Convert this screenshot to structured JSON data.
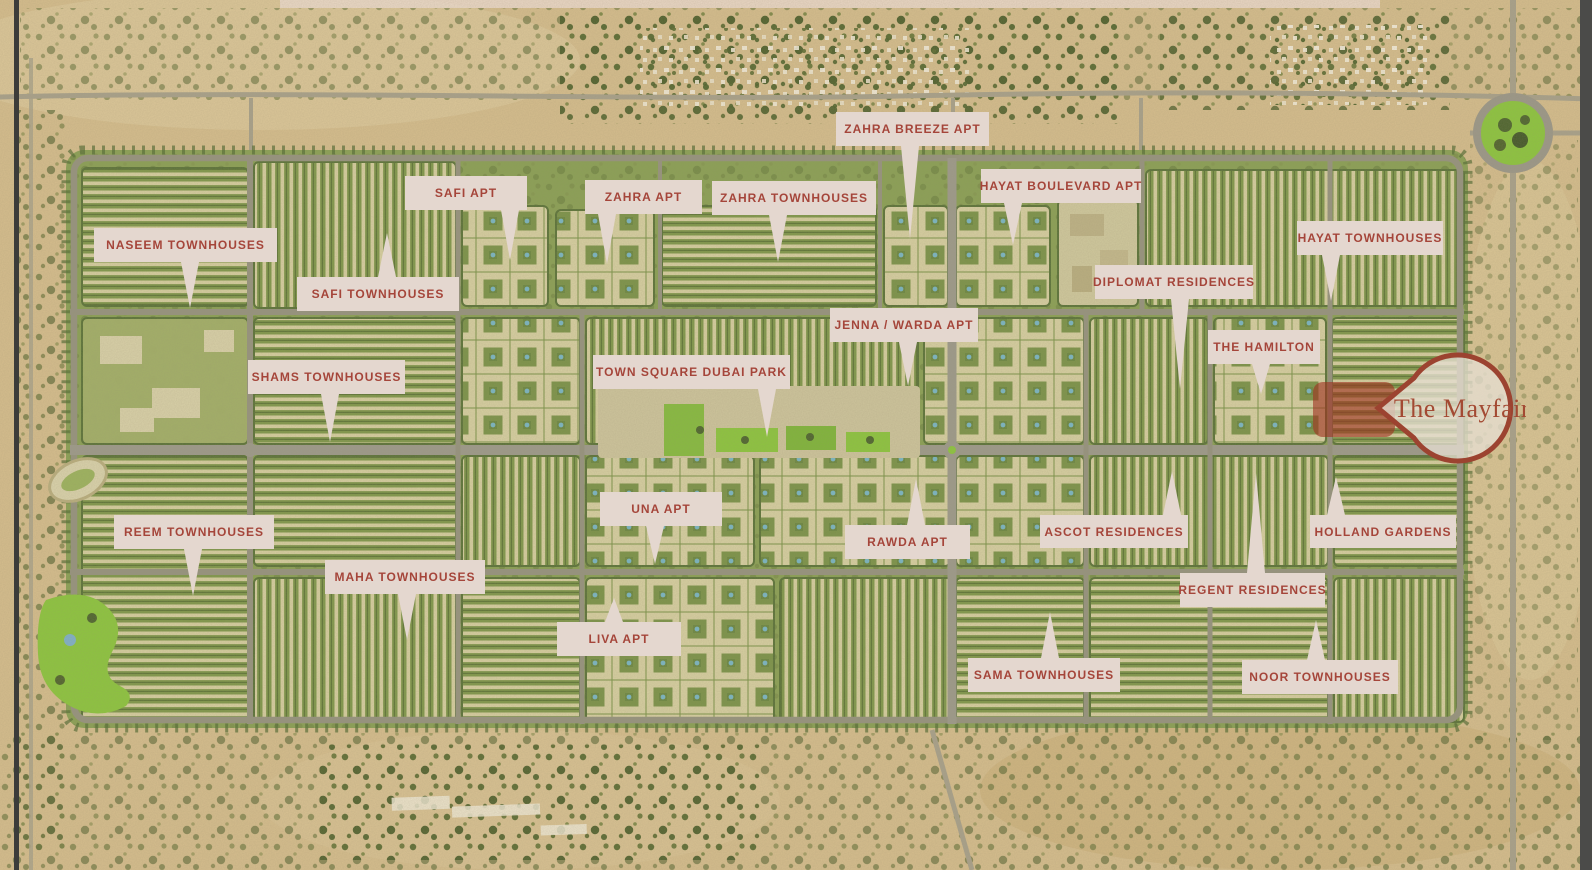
{
  "map": {
    "colors": {
      "label_background": "#e4d7cf",
      "label_text": "#a5453a",
      "pin_border": "#9c4330",
      "pin_fill": "#e6ded1",
      "highlight_block": "#9e3120",
      "sand": "#d5bd8d",
      "development_green": "#8aa055",
      "park_green": "#8cc53e",
      "road_gray": "#96937f"
    },
    "pin": {
      "text": "The Mayfair"
    },
    "labels": [
      {
        "id": "naseem-townhouses",
        "text": "NASEEM TOWNHOUSES",
        "x": 94,
        "y": 228,
        "w": 183,
        "h": 34,
        "tail": {
          "dir": "down",
          "cx": 190,
          "len": 46
        }
      },
      {
        "id": "safi-apt",
        "text": "SAFI APT",
        "x": 405,
        "y": 176,
        "w": 122,
        "h": 34,
        "tail": {
          "dir": "down",
          "cx": 510,
          "len": 50
        }
      },
      {
        "id": "safi-townhouses",
        "text": "SAFI TOWNHOUSES",
        "x": 297,
        "y": 277,
        "w": 162,
        "h": 34,
        "tail": {
          "dir": "up",
          "cx": 387,
          "len": 44
        }
      },
      {
        "id": "zahra-apt",
        "text": "ZAHRA APT",
        "x": 585,
        "y": 180,
        "w": 117,
        "h": 34,
        "tail": {
          "dir": "down",
          "cx": 607,
          "len": 50
        }
      },
      {
        "id": "zahra-townhouses",
        "text": "ZAHRA TOWNHOUSES",
        "x": 712,
        "y": 181,
        "w": 164,
        "h": 34,
        "tail": {
          "dir": "down",
          "cx": 778,
          "len": 47
        }
      },
      {
        "id": "zahra-breeze-apt",
        "text": "ZAHRA BREEZE APT",
        "x": 836,
        "y": 112,
        "w": 153,
        "h": 34,
        "tail": {
          "dir": "down",
          "cx": 910,
          "len": 93
        }
      },
      {
        "id": "hayat-boulevard-apt",
        "text": "HAYAT BOULEVARD APT",
        "x": 981,
        "y": 169,
        "w": 160,
        "h": 34,
        "tail": {
          "dir": "down",
          "cx": 1013,
          "len": 42
        }
      },
      {
        "id": "hayat-townhouses",
        "text": "HAYAT TOWNHOUSES",
        "x": 1297,
        "y": 221,
        "w": 146,
        "h": 34,
        "tail": {
          "dir": "down",
          "cx": 1331,
          "len": 46
        }
      },
      {
        "id": "diplomat-residences",
        "text": "DIPLOMAT RESIDENCES",
        "x": 1095,
        "y": 265,
        "w": 158,
        "h": 34,
        "tail": {
          "dir": "down",
          "cx": 1180,
          "len": 90
        }
      },
      {
        "id": "jenna-warda-apt",
        "text": "JENNA / WARDA APT",
        "x": 830,
        "y": 308,
        "w": 148,
        "h": 34,
        "tail": {
          "dir": "down",
          "cx": 908,
          "len": 44
        }
      },
      {
        "id": "the-hamilton",
        "text": "THE HAMILTON",
        "x": 1208,
        "y": 330,
        "w": 112,
        "h": 34,
        "tail": {
          "dir": "down",
          "cx": 1261,
          "len": 30
        }
      },
      {
        "id": "shams-townhouses",
        "text": "SHAMS TOWNHOUSES",
        "x": 248,
        "y": 360,
        "w": 157,
        "h": 34,
        "tail": {
          "dir": "down",
          "cx": 330,
          "len": 48
        }
      },
      {
        "id": "town-square-dubai-park",
        "text": "TOWN SQUARE DUBAI PARK",
        "x": 593,
        "y": 355,
        "w": 197,
        "h": 34,
        "tail": {
          "dir": "down",
          "cx": 767,
          "len": 48
        }
      },
      {
        "id": "una-apt",
        "text": "UNA APT",
        "x": 600,
        "y": 492,
        "w": 122,
        "h": 34,
        "tail": {
          "dir": "down",
          "cx": 655,
          "len": 38
        }
      },
      {
        "id": "rawda-apt",
        "text": "RAWDA APT",
        "x": 845,
        "y": 525,
        "w": 125,
        "h": 34,
        "tail": {
          "dir": "up",
          "cx": 916,
          "len": 46
        }
      },
      {
        "id": "ascot-residences",
        "text": "ASCOT RESIDENCES",
        "x": 1040,
        "y": 515,
        "w": 148,
        "h": 33,
        "tail": {
          "dir": "up",
          "cx": 1172,
          "len": 44
        }
      },
      {
        "id": "holland-gardens",
        "text": "HOLLAND GARDENS",
        "x": 1310,
        "y": 515,
        "w": 146,
        "h": 33,
        "tail": {
          "dir": "up",
          "cx": 1336,
          "len": 38
        }
      },
      {
        "id": "reem-townhouses",
        "text": "REEM TOWNHOUSES",
        "x": 114,
        "y": 515,
        "w": 160,
        "h": 34,
        "tail": {
          "dir": "down",
          "cx": 193,
          "len": 47
        }
      },
      {
        "id": "maha-townhouses",
        "text": "MAHA TOWNHOUSES",
        "x": 325,
        "y": 560,
        "w": 160,
        "h": 34,
        "tail": {
          "dir": "down",
          "cx": 407,
          "len": 46
        }
      },
      {
        "id": "regent-residences",
        "text": "REGENT RESIDENCES",
        "x": 1180,
        "y": 573,
        "w": 145,
        "h": 34,
        "tail": {
          "dir": "up",
          "cx": 1256,
          "len": 100
        }
      },
      {
        "id": "liva-apt",
        "text": "LIVA APT",
        "x": 557,
        "y": 622,
        "w": 124,
        "h": 34,
        "tail": {
          "dir": "up",
          "cx": 614,
          "len": 24
        }
      },
      {
        "id": "sama-townhouses",
        "text": "SAMA TOWNHOUSES",
        "x": 968,
        "y": 658,
        "w": 152,
        "h": 34,
        "tail": {
          "dir": "up",
          "cx": 1050,
          "len": 46
        }
      },
      {
        "id": "noor-townhouses",
        "text": "NOOR TOWNHOUSES",
        "x": 1242,
        "y": 660,
        "w": 156,
        "h": 34,
        "tail": {
          "dir": "up",
          "cx": 1316,
          "len": 40
        }
      }
    ]
  }
}
